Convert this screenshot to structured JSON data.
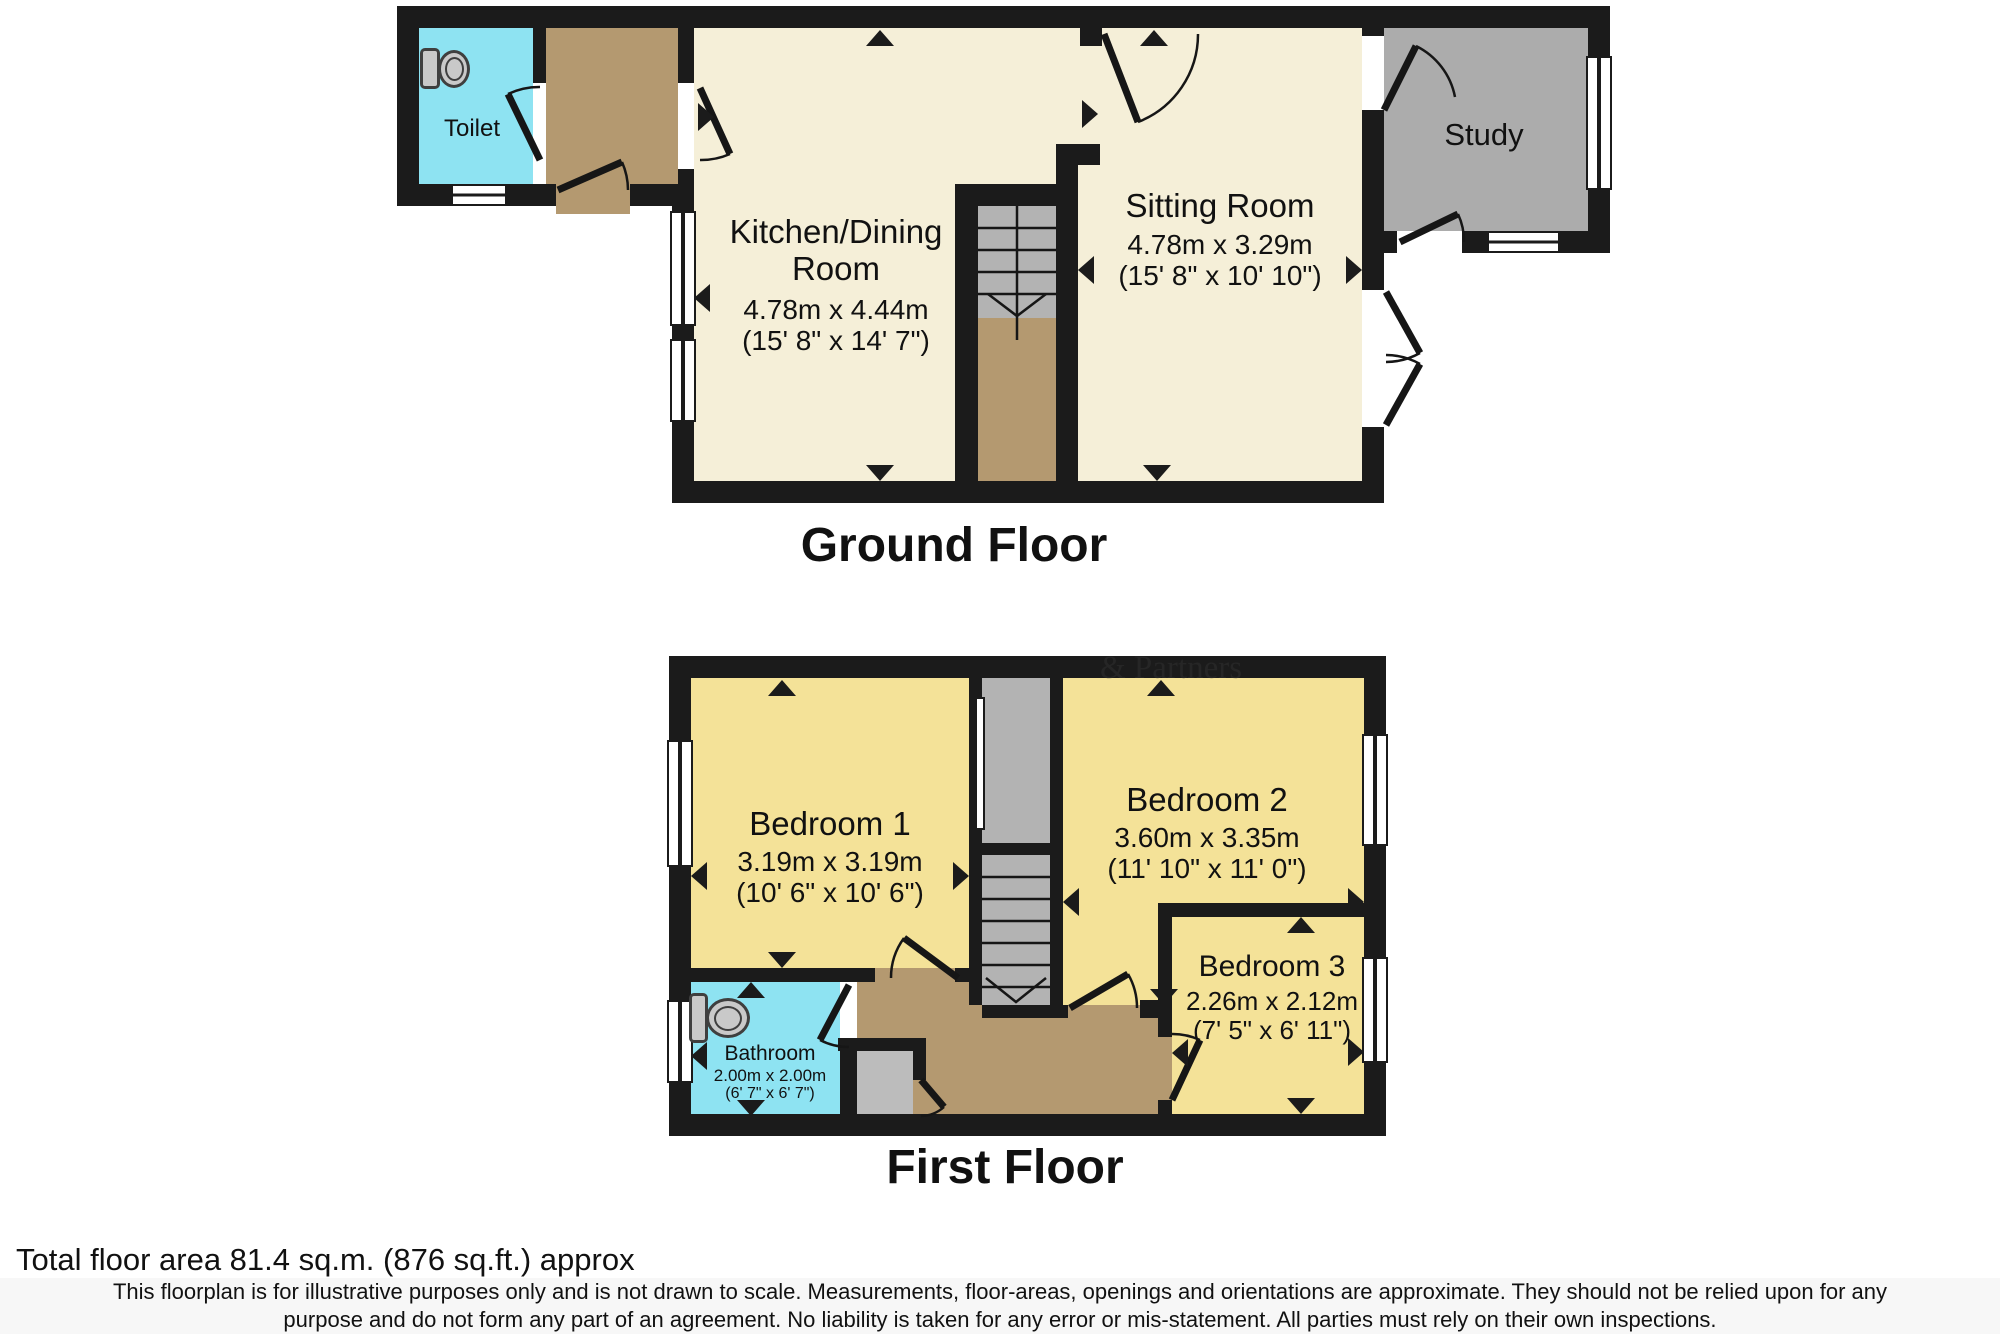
{
  "titles": {
    "ground": "Ground Floor",
    "first": "First Floor"
  },
  "footer": {
    "total_area": "Total floor area 81.4 sq.m. (876 sq.ft.) approx",
    "disclaimer_line1": "This floorplan is for illustrative purposes only and is not drawn to scale. Measurements, floor-areas, openings and orientations are approximate. They should not be relied upon for any",
    "disclaimer_line2": "purpose and do not form any part of an agreement. No liability is taken for any error or mis-statement. All parties must rely on their own inspections."
  },
  "watermark": "& Partners",
  "colors": {
    "wall": "#1b1b1b",
    "cream": "#f5efd8",
    "yellow": "#f4e298",
    "cyan": "#8ee3f2",
    "brown": "#b49970",
    "grayroom": "#acacac",
    "stair": "#b3b3b3",
    "closet": "#bcbcbc",
    "icon": "#c9c9c9",
    "iconline": "#3f3f3f",
    "text": "#111111"
  },
  "rooms": {
    "toilet": {
      "name": "Toilet"
    },
    "kitchen": {
      "name_line1": "Kitchen/Dining",
      "name_line2": "Room",
      "metric": "4.78m x 4.44m",
      "imperial": "(15' 8\" x 14' 7\")"
    },
    "sitting": {
      "name": "Sitting Room",
      "metric": "4.78m x 3.29m",
      "imperial": "(15' 8\" x 10' 10\")"
    },
    "study": {
      "name": "Study"
    },
    "bedroom1": {
      "name": "Bedroom 1",
      "metric": "3.19m x 3.19m",
      "imperial": "(10' 6\" x 10' 6\")"
    },
    "bedroom2": {
      "name": "Bedroom 2",
      "metric": "3.60m x 3.35m",
      "imperial": "(11' 10\" x 11' 0\")"
    },
    "bedroom3": {
      "name": "Bedroom 3",
      "metric": "2.26m x 2.12m",
      "imperial": "(7' 5\" x 6' 11\")"
    },
    "bathroom": {
      "name": "Bathroom",
      "metric": "2.00m x 2.00m",
      "imperial": "(6' 7\" x 6' 7\")"
    }
  }
}
